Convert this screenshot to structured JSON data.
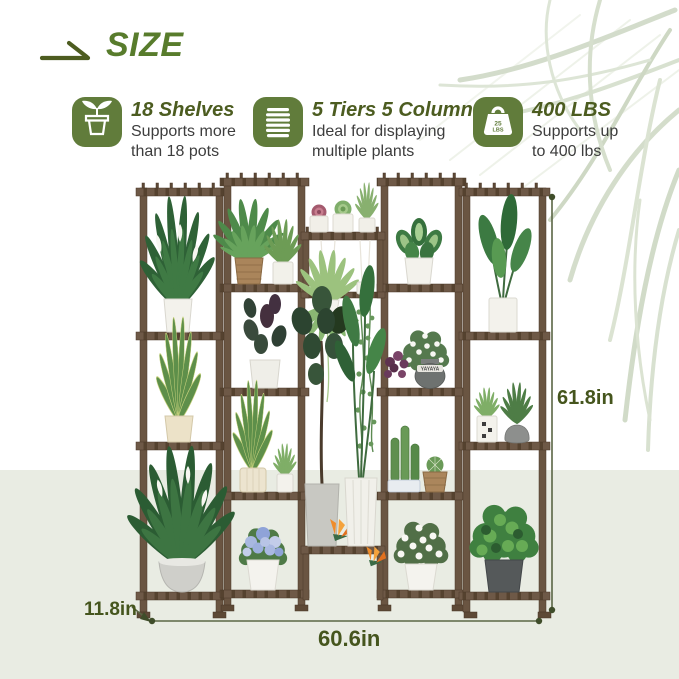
{
  "header": {
    "title": "SIZE"
  },
  "features": [
    {
      "icon": "potted-plant-icon",
      "title": "18 Shelves",
      "line1": "Supports more",
      "line2": "than 18 pots"
    },
    {
      "icon": "tiers-columns-icon",
      "title": "5 Tiers 5 Columns",
      "line1": "Ideal for displaying",
      "line2": "multiple plants"
    },
    {
      "icon": "weight-capacity-icon",
      "weight_top": "25",
      "weight_bottom": "LBS",
      "title": "400 LBS",
      "line1": "Supports up",
      "line2": "to 400 lbs"
    }
  ],
  "dimensions": {
    "height": "61.8in",
    "depth": "11.8in",
    "width": "60.6in"
  },
  "illustration": {
    "pot_label": "YAYAYA"
  },
  "colors": {
    "accent_green": "#587c2c",
    "icon_green": "#617c3b",
    "title_olive": "#4c5c20",
    "text_dark": "#3d3d3d",
    "dimension_olive": "#45551d",
    "wood_brown": "#6e5947",
    "background_band": "#e9ece3",
    "palm_sage": "#ccd7c2"
  }
}
